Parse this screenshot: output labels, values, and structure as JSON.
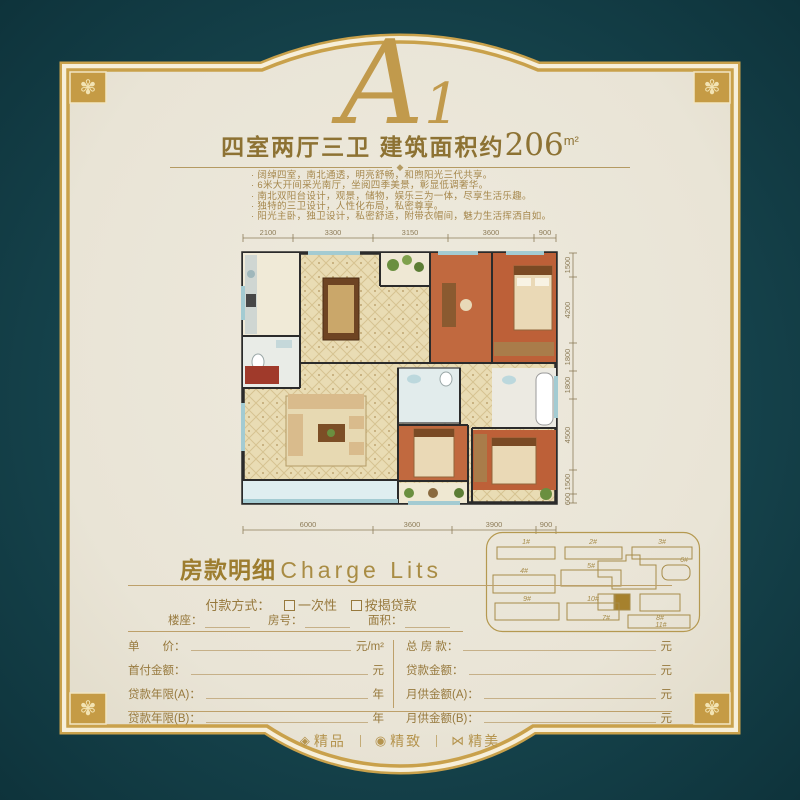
{
  "page": {
    "plan_code_letter": "A",
    "plan_code_digit": "1",
    "title_prefix": "四室两厅三卫 建筑面积约",
    "title_number": "206",
    "title_unit": "m²"
  },
  "features": [
    "阔绰四室，南北通透，明亮舒畅，和煦阳光三代共享。",
    "6米大开间采光南厅，坐阅四季美景，彰显低调奢华。",
    "南北双阳台设计，观景，储物，娱乐三为一体，尽享生活乐趣。",
    "独特的三卫设计，人性化布局，私密尊享。",
    "阳光主卧，独卫设计，私密舒适，附带衣帽间，魅力生活挥洒自如。"
  ],
  "floor_plan": {
    "dims_top": [
      "2100",
      "3300",
      "3150",
      "3600",
      "900"
    ],
    "dims_right": [
      "1500",
      "4200",
      "1800",
      "1800",
      "4500",
      "1500",
      "600"
    ],
    "dims_bottom": [
      "6000",
      "3600",
      "3900",
      "900"
    ]
  },
  "site_plan": {
    "buildings": [
      "1#",
      "2#",
      "3#",
      "4#",
      "5#",
      "6#",
      "7#",
      "8#",
      "9#",
      "10#",
      "11#"
    ],
    "highlighted": "7#"
  },
  "charge": {
    "title_zh": "房款明细",
    "title_en": "Charge Lits",
    "payment_label": "付款方式：",
    "options": [
      {
        "label": "一次性"
      },
      {
        "label": "按揭贷款"
      }
    ],
    "info_fields": [
      "楼座：",
      "房号：",
      "面积："
    ],
    "left_rows": [
      {
        "label": "单　　价：",
        "unit": "元/m²"
      },
      {
        "label": "首付金额：",
        "unit": "元"
      },
      {
        "label": "贷款年限(A)：",
        "unit": "年"
      },
      {
        "label": "贷款年限(B)：",
        "unit": "年"
      }
    ],
    "right_rows": [
      {
        "label": "总 房 款：",
        "unit": "元"
      },
      {
        "label": "贷款金额：",
        "unit": "元"
      },
      {
        "label": "月供金额(A)：",
        "unit": "元"
      },
      {
        "label": "月供金额(B)：",
        "unit": "元"
      }
    ]
  },
  "footer": {
    "items": [
      {
        "icon": "gem-icon",
        "glyph": "◈",
        "label": "精品"
      },
      {
        "icon": "medal-icon",
        "glyph": "◉",
        "label": "精致"
      },
      {
        "icon": "bowtie-icon",
        "glyph": "⋈",
        "label": "精美"
      }
    ]
  },
  "ornaments": {
    "corner_glyph": "✾",
    "divider_glyph": "◆"
  },
  "colors": {
    "background_teal": "#16444d",
    "frame_gold": "#c9a14b",
    "frame_ivory": "#f7efd9",
    "panel_cream": "#ebe7da",
    "accent_text_gold": "#97793d",
    "bedroom_terracotta": "#c1693f",
    "tile_beige": "#e9dcb4",
    "glass_blue": "#a3cbd2"
  }
}
